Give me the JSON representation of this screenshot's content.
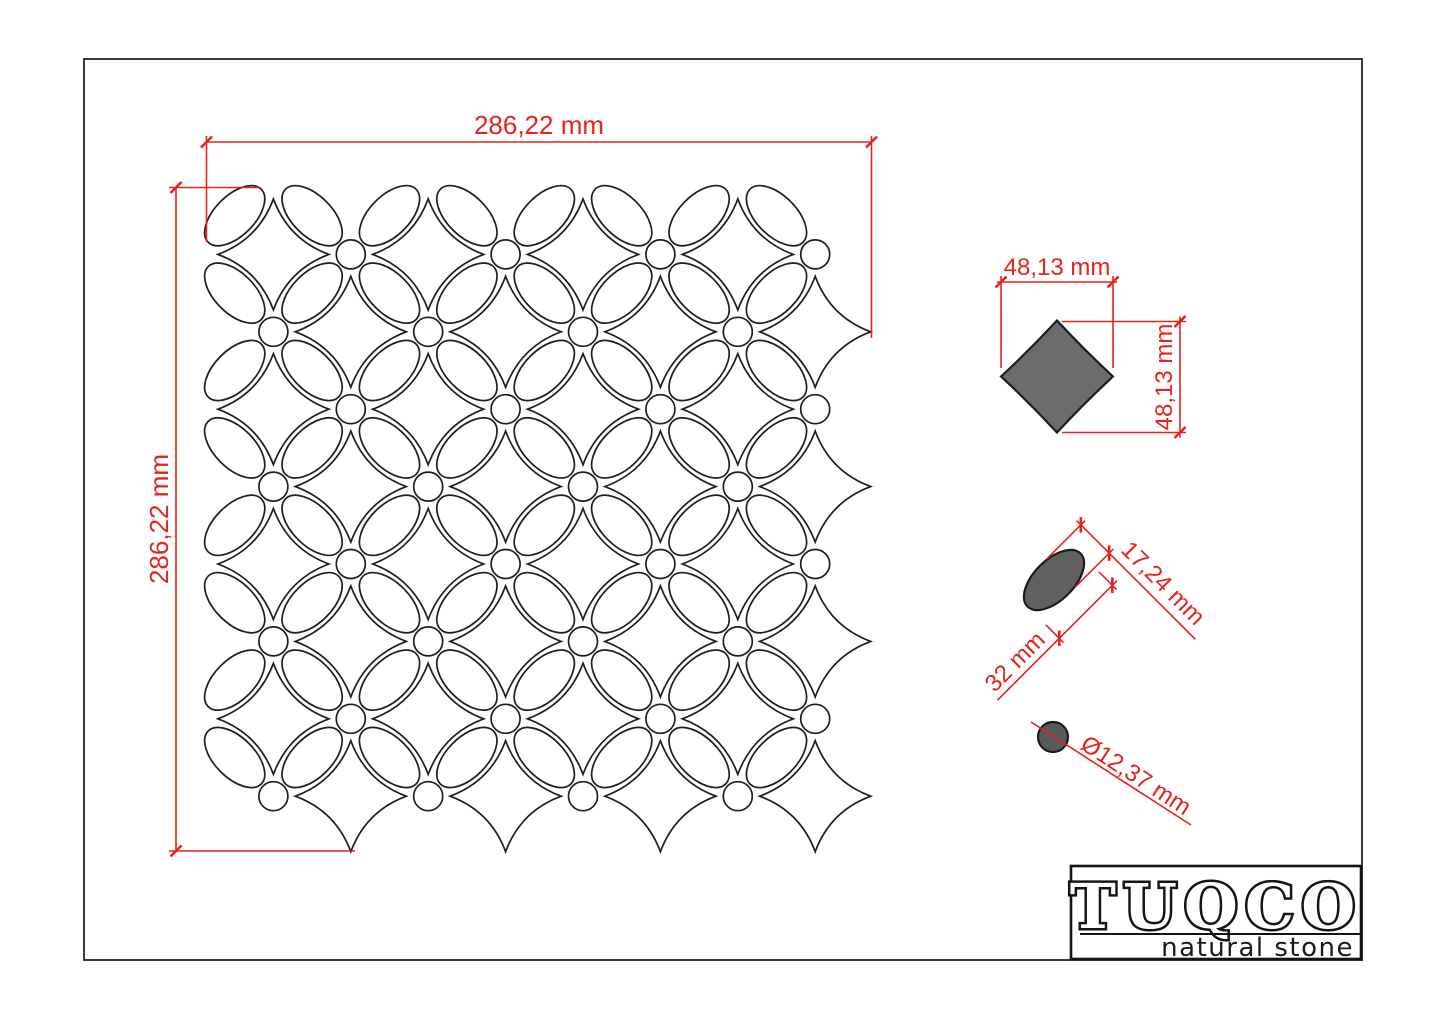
{
  "drawing": {
    "title": "mosaic tile sheet technical drawing",
    "sheet": {
      "width_label": "286,22 mm",
      "height_label": "286,22 mm"
    },
    "star_detail": {
      "width_label": "48,13 mm",
      "height_label": "48,13 mm"
    },
    "ellipse_detail": {
      "length_label": "32 mm",
      "width_label": "17,24 mm"
    },
    "dot_detail": {
      "diameter_label": "Ø12,37 mm"
    },
    "colors": {
      "dimension_red": "#e6231d",
      "linework": "#1f1f1f",
      "page_border": "#3a3a3a",
      "star_fill": "#6c6c6e",
      "ellipse_fill": "#616163",
      "dot_fill": "#59595b",
      "background": "#ffffff"
    }
  },
  "logo": {
    "brand": "TUQCO",
    "tagline": "natural stone"
  }
}
